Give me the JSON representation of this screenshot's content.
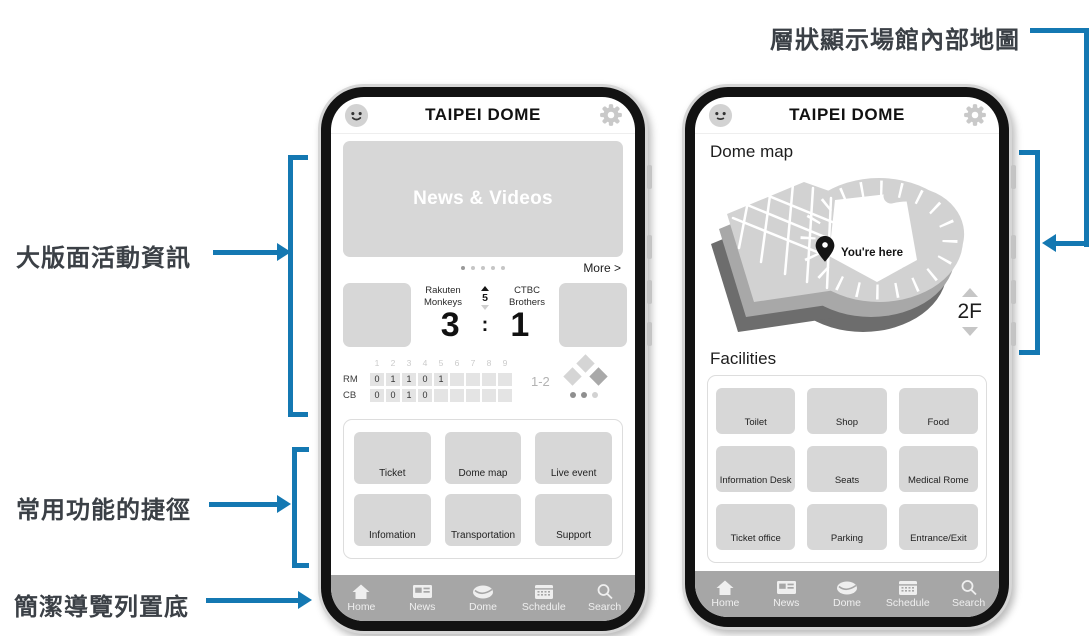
{
  "colors": {
    "accent": "#1478b2",
    "annotation_text": "#3b4046",
    "tile": "#d7d7d7",
    "navbar": "#a6a6a6"
  },
  "annotations": {
    "map_layers": "層狀顯示場館內部地圖",
    "event_info": "大版面活動資訊",
    "shortcuts": "常用功能的捷徑",
    "bottom_nav": "簡潔導覽列置底"
  },
  "nav": {
    "items": [
      {
        "label": "Home",
        "icon": "home-icon"
      },
      {
        "label": "News",
        "icon": "news-icon"
      },
      {
        "label": "Dome",
        "icon": "dome-icon"
      },
      {
        "label": "Schedule",
        "icon": "schedule-icon"
      },
      {
        "label": "Search",
        "icon": "search-icon"
      }
    ]
  },
  "phone_left": {
    "header": {
      "title": "TAIPEI DOME"
    },
    "news_card": {
      "label": "News & Videos"
    },
    "more_link": "More >",
    "scoreboard": {
      "home_team": "Rakuten Monkeys",
      "away_team": "CTBC Brothers",
      "inning": "5",
      "home_score": "3",
      "separator": ":",
      "away_score": "1",
      "innings_header": [
        "1",
        "2",
        "3",
        "4",
        "5",
        "6",
        "7",
        "8",
        "9"
      ],
      "rows": [
        {
          "team": "RM",
          "scores": [
            "0",
            "1",
            "1",
            "0",
            "1",
            "",
            "",
            "",
            ""
          ]
        },
        {
          "team": "CB",
          "scores": [
            "0",
            "0",
            "1",
            "0",
            "",
            "",
            "",
            "",
            ""
          ]
        }
      ],
      "count": "1-2"
    },
    "shortcuts": [
      {
        "label": "Ticket"
      },
      {
        "label": "Dome map"
      },
      {
        "label": "Live event"
      },
      {
        "label": "Infomation"
      },
      {
        "label": "Transportation"
      },
      {
        "label": "Support"
      }
    ]
  },
  "phone_right": {
    "header": {
      "title": "TAIPEI DOME"
    },
    "section_title": "Dome map",
    "map": {
      "you_are_here": "You're here",
      "floor": "2F"
    },
    "facilities_title": "Facilities",
    "facilities": [
      {
        "label": "Toilet"
      },
      {
        "label": "Shop"
      },
      {
        "label": "Food"
      },
      {
        "label": "Information Desk"
      },
      {
        "label": "Seats"
      },
      {
        "label": "Medical Rome"
      },
      {
        "label": "Ticket office"
      },
      {
        "label": "Parking"
      },
      {
        "label": "Entrance/Exit"
      }
    ]
  }
}
